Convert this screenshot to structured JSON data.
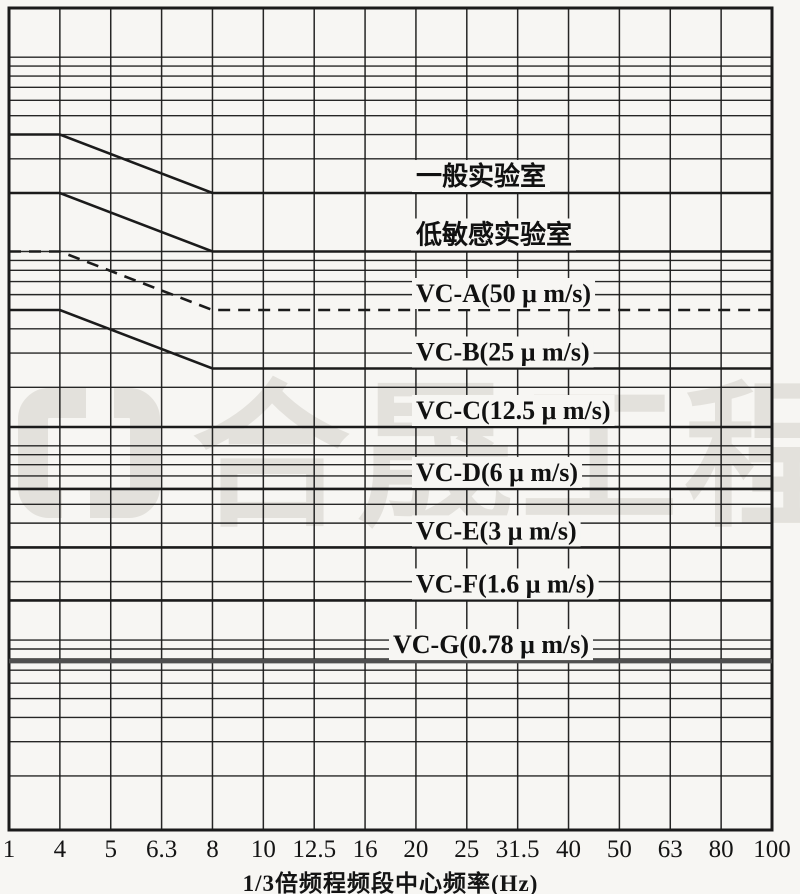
{
  "colors": {
    "paper": "#f7f6f3",
    "ink": "#1b1b1b",
    "bold_line": "#4f4f4f",
    "watermark": "#e3e1dc"
  },
  "watermark": {
    "text": "合晟工程",
    "logo": "bracket-square-logo"
  },
  "x_axis": {
    "title": "1/3倍频程频段中心频率(Hz)",
    "tick_values": [
      1,
      4,
      5,
      6.3,
      8,
      10,
      12.5,
      16,
      20,
      25,
      31.5,
      40,
      50,
      63,
      80,
      100
    ]
  },
  "chart_data": {
    "type": "line",
    "title": "",
    "xlabel": "1/3倍频程频段中心频率(Hz)",
    "ylabel": "",
    "y_unit": "μm/s",
    "x_scale": "1/3-octave bands, equal spacing per labeled band",
    "y_scale": "log",
    "x_range_hz": [
      1,
      100
    ],
    "y_range_um_s": [
      0.11,
      1800
    ],
    "grid": "on",
    "legend_position": "labels-on-lines",
    "x_ticks": [
      1,
      4,
      5,
      6.3,
      8,
      10,
      12.5,
      16,
      20,
      25,
      31.5,
      40,
      50,
      63,
      80,
      100
    ],
    "y_gridlines": [
      1000,
      900,
      800,
      700,
      600,
      500,
      400,
      300,
      200,
      100,
      90,
      80,
      70,
      60,
      40,
      30,
      20,
      10,
      9,
      8,
      7,
      6,
      5,
      4,
      3,
      2,
      1,
      0.9,
      0.8,
      0.7,
      0.6,
      0.5,
      0.4,
      0.3,
      0.2
    ],
    "series": [
      {
        "id": "general-lab",
        "name": "一般实验室",
        "style": "solid",
        "points": [
          [
            1,
            400
          ],
          [
            4,
            400
          ],
          [
            8,
            200
          ],
          [
            100,
            200
          ]
        ]
      },
      {
        "id": "low-sensitivity-lab",
        "name": "低敏感实验室",
        "style": "solid",
        "points": [
          [
            1,
            200
          ],
          [
            4,
            200
          ],
          [
            8,
            100
          ],
          [
            100,
            100
          ]
        ]
      },
      {
        "id": "vc-a",
        "name": "VC-A(50 μ m/s)",
        "style": "dashed",
        "points": [
          [
            1,
            100
          ],
          [
            4,
            100
          ],
          [
            8,
            50
          ],
          [
            100,
            50
          ]
        ]
      },
      {
        "id": "vc-b",
        "name": "VC-B(25 μ m/s)",
        "style": "solid",
        "points": [
          [
            1,
            50
          ],
          [
            4,
            50
          ],
          [
            8,
            25
          ],
          [
            100,
            25
          ]
        ]
      },
      {
        "id": "vc-c",
        "name": "VC-C(12.5 μ m/s)",
        "style": "solid",
        "points": [
          [
            1,
            12.5
          ],
          [
            100,
            12.5
          ]
        ]
      },
      {
        "id": "vc-d",
        "name": "VC-D(6 μ m/s)",
        "style": "solid",
        "points": [
          [
            1,
            6
          ],
          [
            100,
            6
          ]
        ]
      },
      {
        "id": "vc-e",
        "name": "VC-E(3 μ m/s)",
        "style": "solid",
        "points": [
          [
            1,
            3
          ],
          [
            100,
            3
          ]
        ]
      },
      {
        "id": "vc-f",
        "name": "VC-F(1.6 μ m/s)",
        "style": "solid",
        "points": [
          [
            1,
            1.6
          ],
          [
            100,
            1.6
          ]
        ]
      },
      {
        "id": "vc-g",
        "name": "VC-G(0.78 μ m/s)",
        "style": "bold",
        "points": [
          [
            1,
            0.78
          ],
          [
            100,
            0.78
          ]
        ]
      }
    ]
  }
}
